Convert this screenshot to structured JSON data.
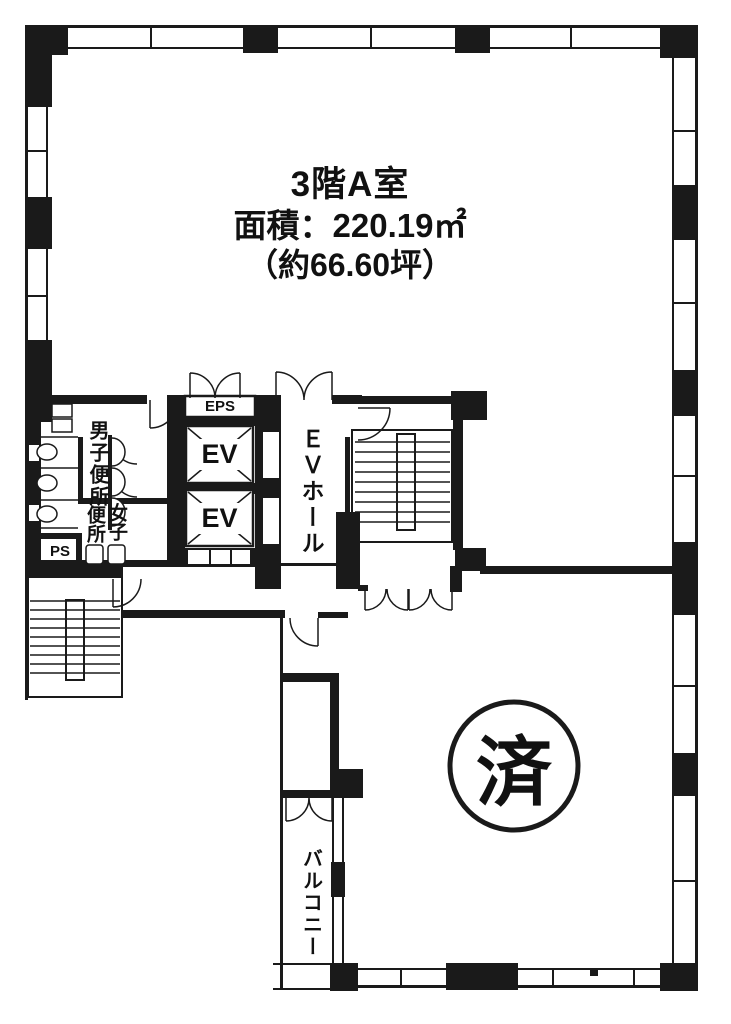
{
  "page": {
    "background": "#ffffff",
    "ink": "#1a1a1a"
  },
  "unit": {
    "title": "3階A室",
    "area_line": "面積：220.19㎡",
    "area_tsubo_line": "（約66.60坪）"
  },
  "labels": {
    "eps": "EPS",
    "elevator_top": "EV",
    "elevator_bottom": "EV",
    "ev_hall": "ＥＶホール",
    "mens_toilet": "男子便所",
    "womens_toilet_col_right": "女子",
    "womens_toilet_col_left": "便所",
    "pipe_space": "PS",
    "balcony": "バルコニー",
    "stamp": "済"
  }
}
